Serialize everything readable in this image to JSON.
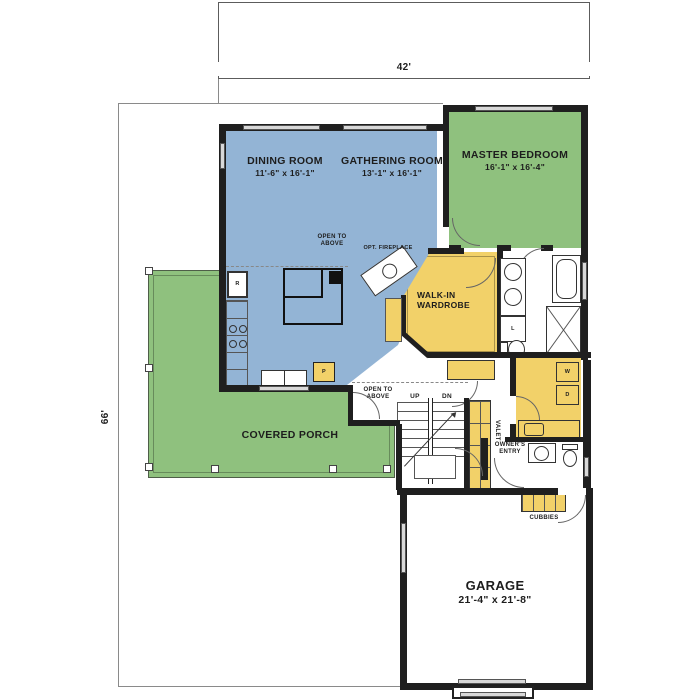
{
  "colors": {
    "blue": "#93b4d5",
    "green": "#8fc17e",
    "yellow": "#f2d169",
    "wall": "#1f1f1f"
  },
  "dimensions": {
    "width": "42'",
    "height": "66'"
  },
  "rooms": {
    "dining": {
      "name": "DINING ROOM",
      "size": "11'-6\" x 16'-1\""
    },
    "gathering": {
      "name": "GATHERING ROOM",
      "size": "13'-1\" x 16'-1\""
    },
    "master_bedroom": {
      "name": "MASTER BEDROOM",
      "size": "16'-1\" x 16'-4\""
    },
    "garage": {
      "name": "GARAGE",
      "size": "21'-4\" x 21'-8\""
    },
    "covered_porch": {
      "name": "COVERED PORCH"
    },
    "walk_in_wardrobe": {
      "name": "WALK-IN WARDROBE"
    }
  },
  "annotations": {
    "open_to_above_gathering": "OPEN TO ABOVE",
    "open_to_above_stairs": "OPEN TO ABOVE",
    "opt_fireplace": "OPT. FIREPLACE",
    "up": "UP",
    "dn": "DN",
    "valet": "VALET",
    "owners_entry": "OWNER'S ENTRY",
    "cubbies": "CUBBIES"
  },
  "fixture_letters": {
    "refrigerator": "R",
    "pantry": "P",
    "linen": "L",
    "washer": "W",
    "dryer": "D"
  }
}
